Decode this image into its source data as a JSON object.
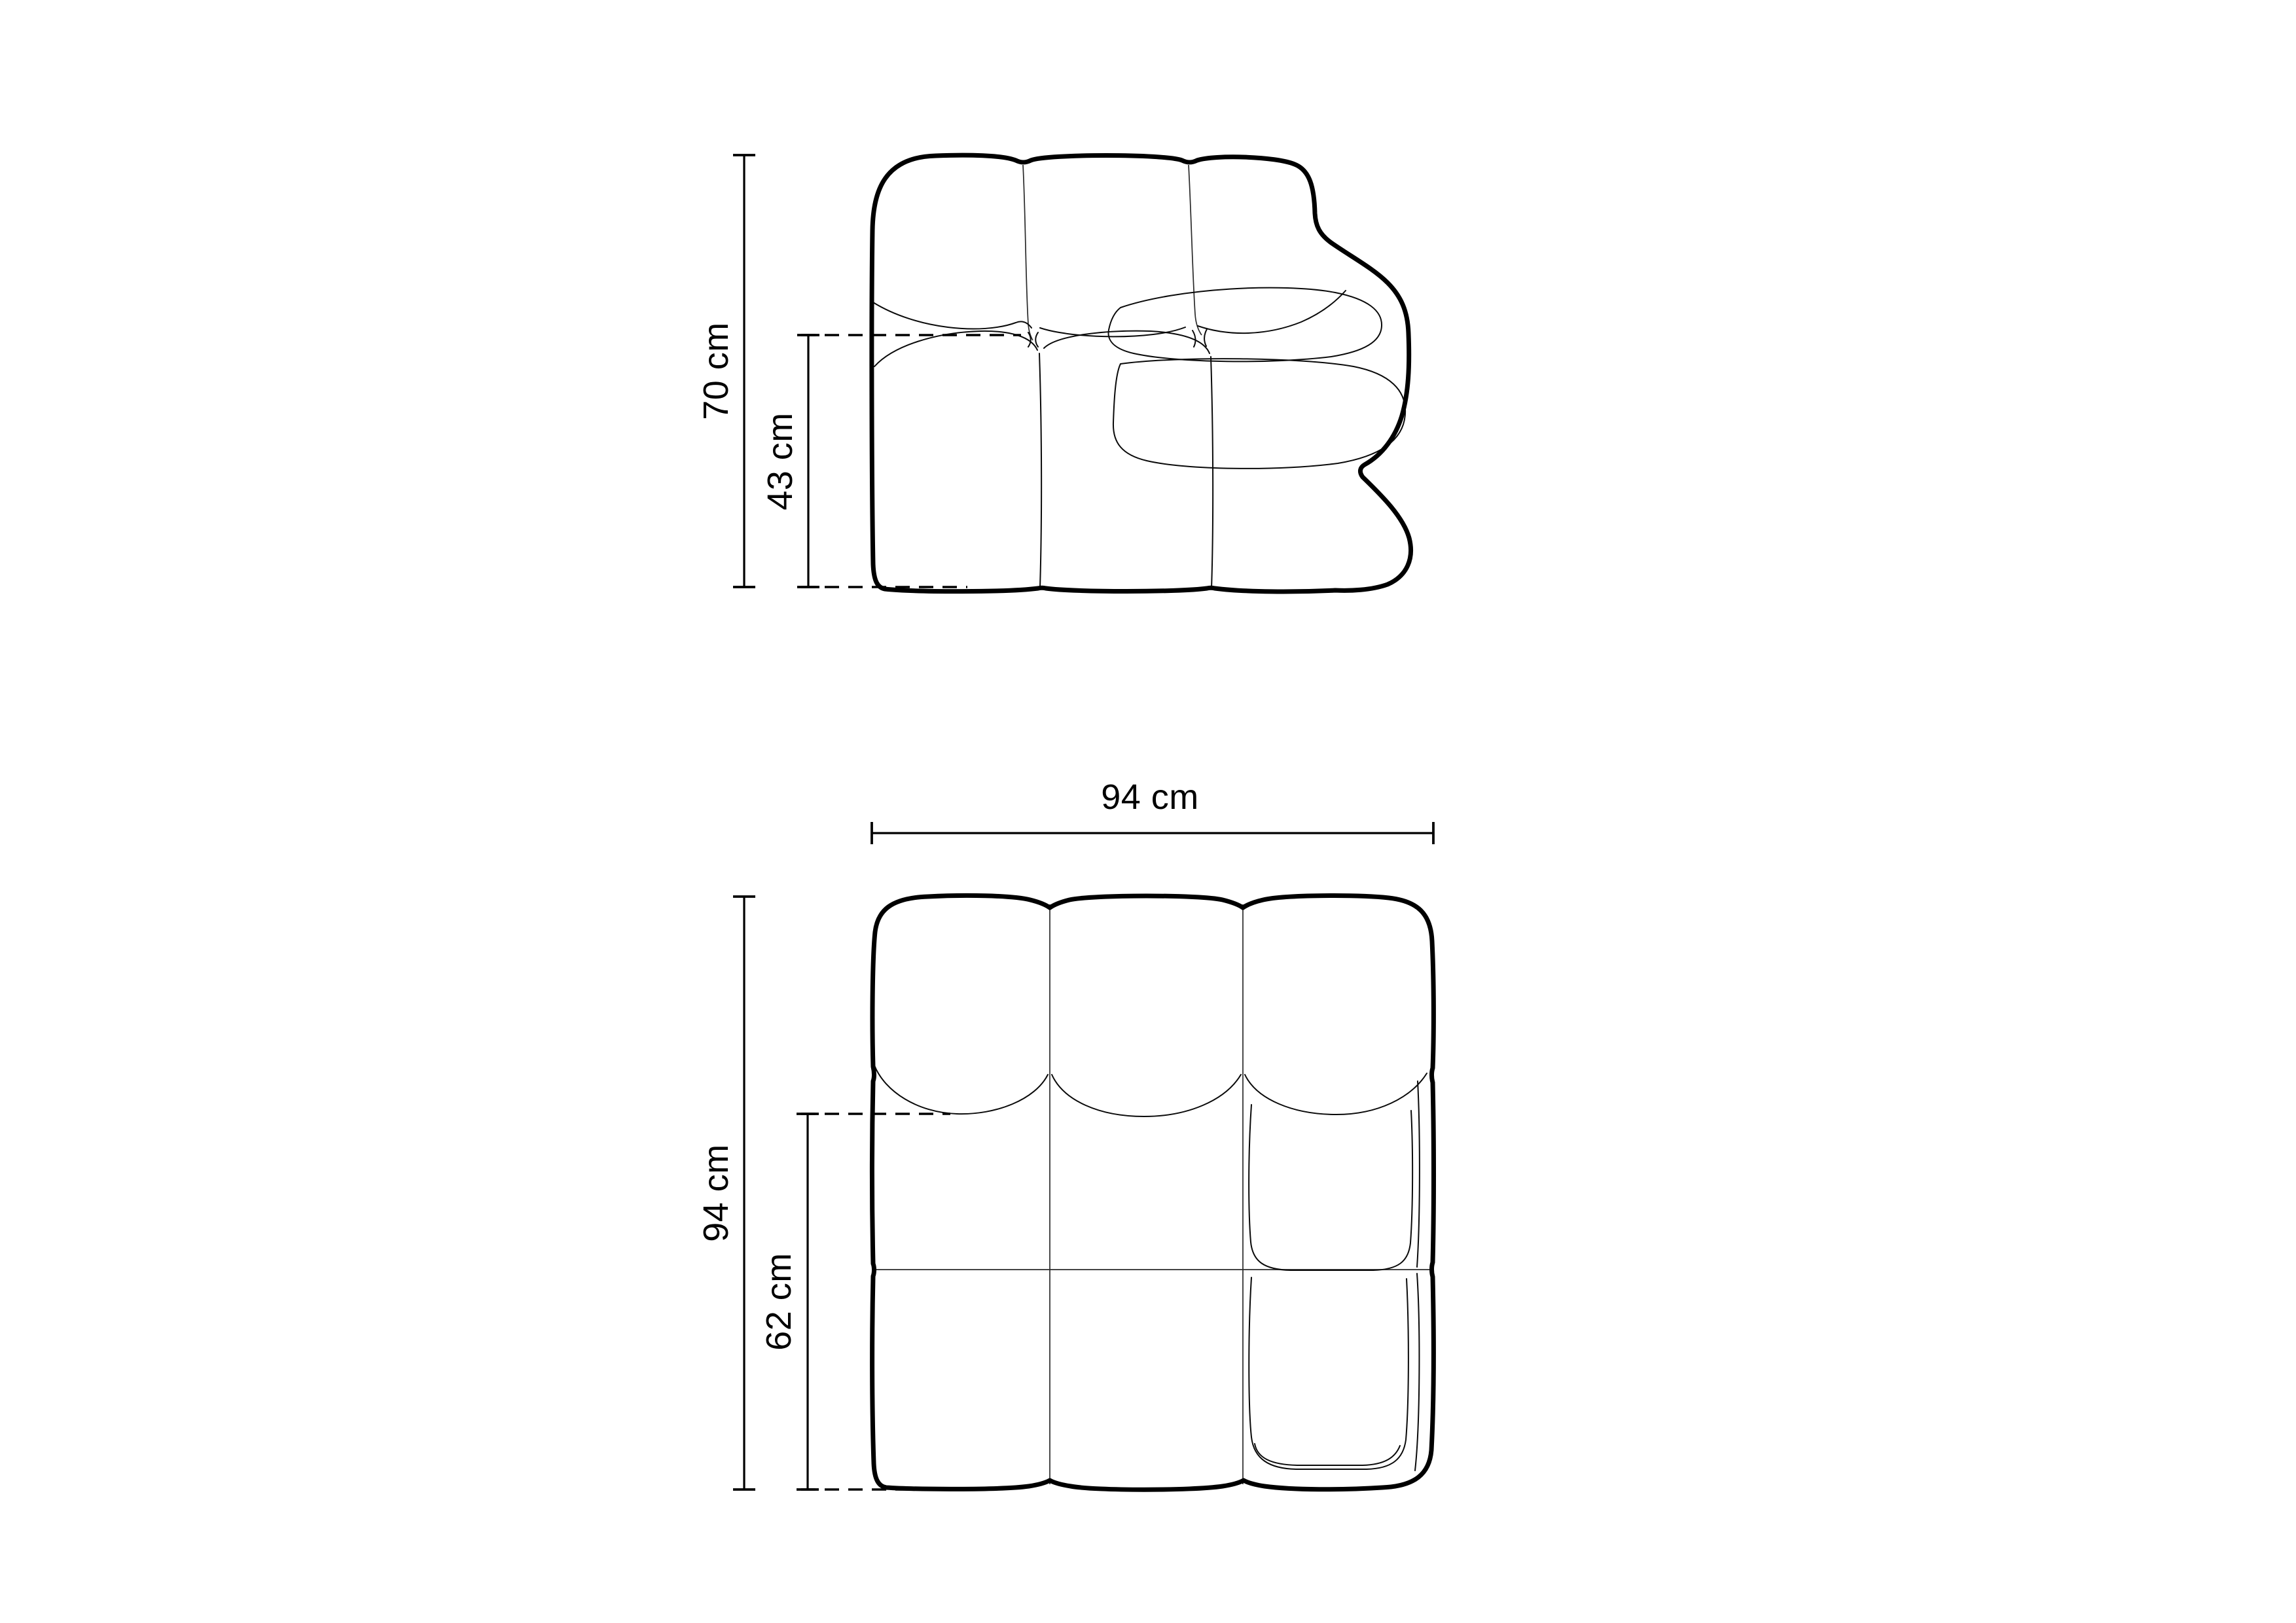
{
  "drawing": {
    "background_color": "#ffffff",
    "line_color": "#000000",
    "front_view": {
      "dimensions": {
        "total_height": "70 cm",
        "seat_height": "43 cm"
      }
    },
    "top_view": {
      "dimensions": {
        "total_width": "94 cm",
        "total_depth": "94 cm",
        "seat_depth": "62 cm"
      }
    }
  }
}
